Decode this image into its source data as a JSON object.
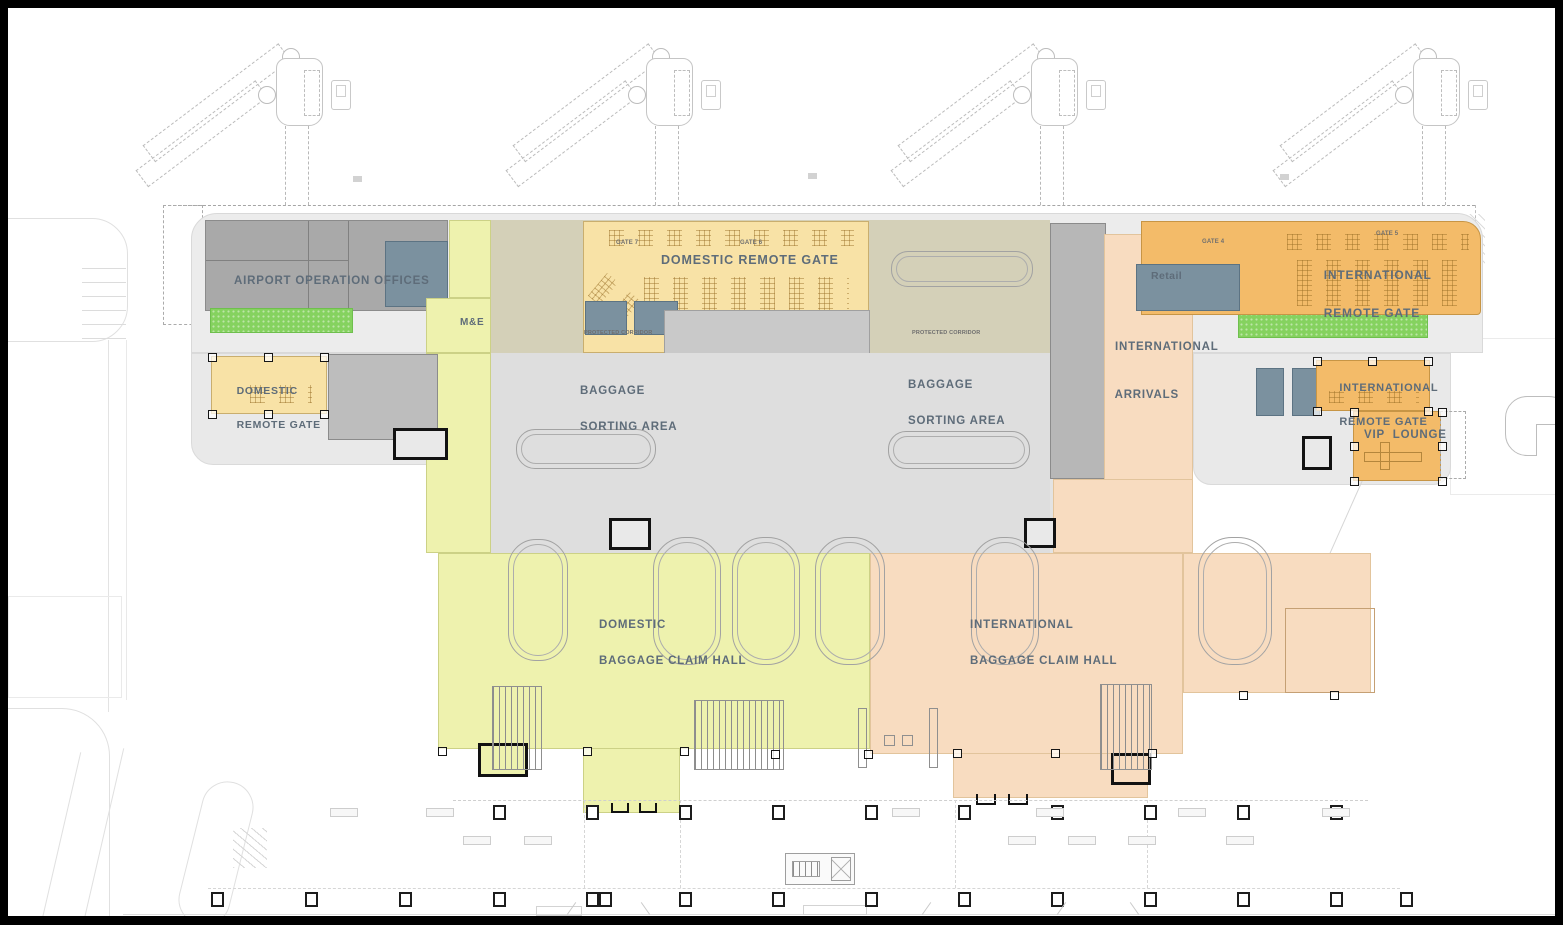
{
  "plan_labels": {
    "airport_operation_offices": "AIRPORT OPERATION OFFICES",
    "me": "M&E",
    "domestic_remote_gate_left": {
      "l1": "DOMESTIC",
      "l2": "REMOTE GATE"
    },
    "domestic_remote_gate_main": "DOMESTIC REMOTE GATE",
    "gate7": "GATE 7",
    "gate6": "GATE 6",
    "gate4": "GATE 4",
    "gate5": "GATE 5",
    "protected_corridor_left": "PROTECTED CORRIDOR",
    "protected_corridor_right": "PROTECTED CORRIDOR",
    "baggage_sorting_left": {
      "l1": "BAGGAGE",
      "l2": "SORTING AREA"
    },
    "baggage_sorting_right": {
      "l1": "BAGGAGE",
      "l2": "SORTING AREA"
    },
    "international_arrivals": {
      "l1": "INTERNATIONAL",
      "l2": "ARRIVALS"
    },
    "retail": "Retail",
    "intl_remote_gate_main": {
      "l1": "INTERNATIONAL",
      "l2": "REMOTE GATE"
    },
    "intl_remote_gate_right": {
      "l1": "INTERNATIONAL",
      "l2": "REMOTE GATE"
    },
    "vip_lounge": "VIP  LOUNGE",
    "domestic_claim": {
      "l1": "DOMESTIC",
      "l2": "BAGGAGE CLAIM HALL"
    },
    "international_claim": {
      "l1": "INTERNATIONAL",
      "l2": "BAGGAGE CLAIM HALL"
    }
  },
  "colors": {
    "domestic_zone_yellow": "#eef2ae",
    "international_zone_peach": "#f8dcc0",
    "remote_gate_tan": "#f8e2a6",
    "remote_gate_orange": "#f3bb69",
    "landscape_green": "#85d25f",
    "offices_gray": "#a9a9a9",
    "sorting_gray": "#dedede",
    "corridor_olive": "#d4d0b8",
    "wet_core_bluegray": "#7b919f",
    "label_ink": "#5e6c79"
  }
}
